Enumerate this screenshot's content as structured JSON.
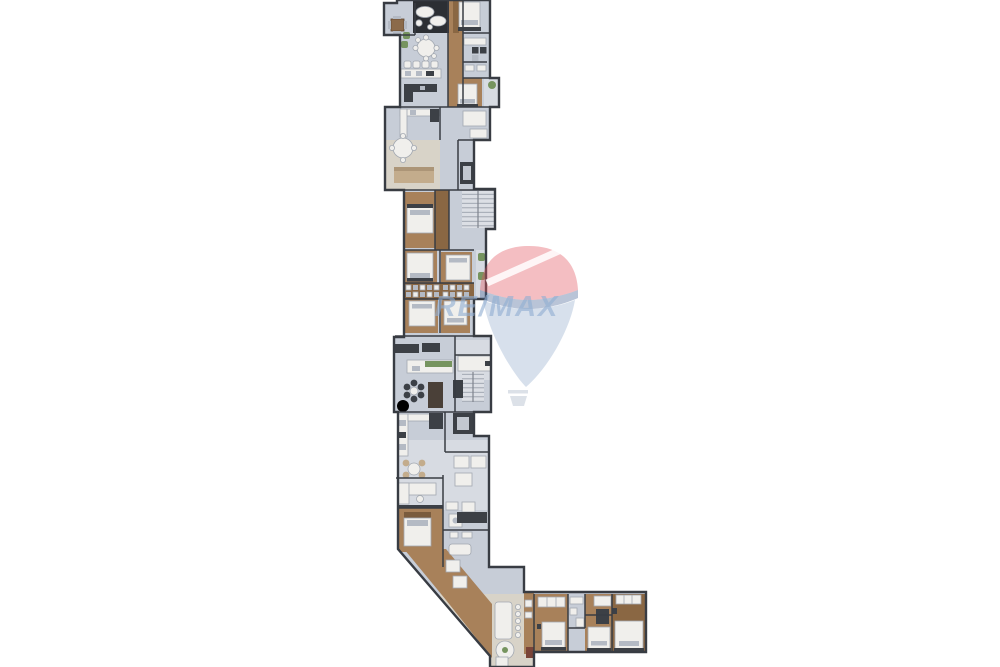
{
  "page": {
    "background": "#ffffff",
    "description": "Top-down 3D architectural floor plan rendering of an L-shaped residential building, cropped at top and bottom image edges, with a semi-transparent RE/MAX balloon watermark"
  },
  "watermark": {
    "brand": "RE/MAX",
    "visible_text": "E/MAX",
    "element": "hot-air-balloon-logo",
    "colors": {
      "balloon_top": "#e15560",
      "balloon_stripe": "#ffffff",
      "balloon_band": "#46648f",
      "balloon_bottom": "#a0b4d2",
      "basket": "#b9c3d2",
      "text": "#92aed2"
    },
    "opacity": 0.45
  },
  "palette": {
    "bg": "#ffffff",
    "tile": "#c7cdd7",
    "tile-light": "#d7dbe2",
    "beige": "#d8d3c8",
    "wood": "#a8815a",
    "wood-dark": "#8a6743",
    "wall": "#383c43",
    "white-furn": "#f0efec",
    "furn-stroke": "#a2a8b1",
    "dark-furn": "#3c4046",
    "tan": "#c3ac8c",
    "green": "#76945f",
    "orange": "#bf6c3c",
    "stair": "#dcdfe5"
  },
  "plan": {
    "type": "floor-plan",
    "shape": "Narrow vertical wing running from the top edge down the center-left, a diagonal cut at lower left, and a horizontal bedroom wing extending right near the bottom; plan continues past top and bottom crop edges",
    "vertical_wing_rooms": [
      "den-with-table",
      "lounge-dark-rug",
      "bedroom",
      "bathroom-laundry",
      "round-dining",
      "kitchen-bar-with-stools",
      "kitchen-island",
      "bedroom-suite",
      "balcony-with-plant",
      "living-dining-kitchen",
      "storage",
      "elevator",
      "staircase",
      "bedroom",
      "bedroom",
      "wardrobe-closet-strip",
      "bedroom",
      "bedroom",
      "balconies-with-planters",
      "kitchen-island-with-herbs",
      "breakfast-set",
      "tall-cabinet",
      "staircase",
      "elevator",
      "kitchen",
      "wicker-dining-set",
      "living-sofa",
      "bedroom",
      "bathrooms",
      "utility"
    ],
    "bottom_wing_rooms": [
      "laundry-utility",
      "long-dining-table-with-chairs",
      "round-table-with-plant",
      "bedroom-with-closet",
      "bathroom",
      "bedroom",
      "master-bedroom-with-closet"
    ]
  }
}
